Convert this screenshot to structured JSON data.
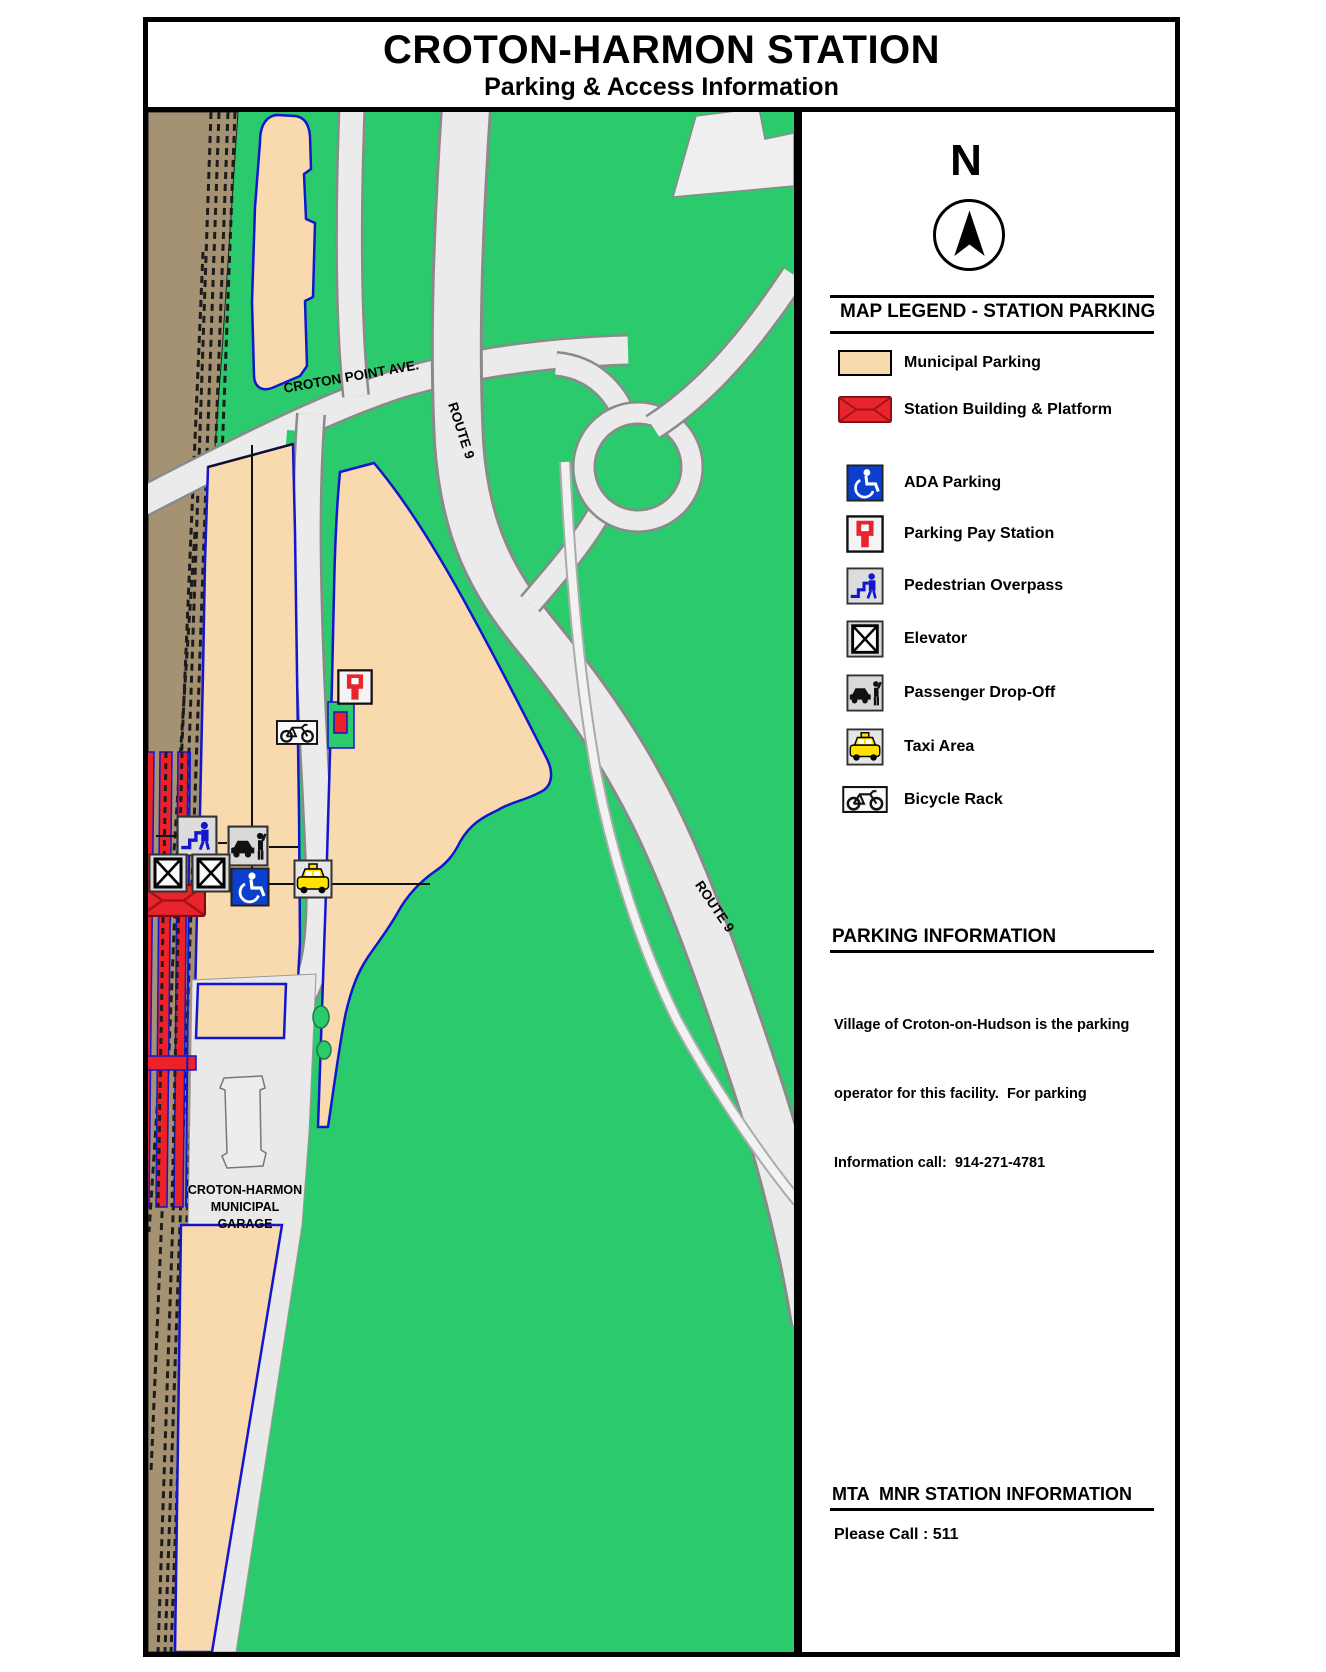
{
  "page": {
    "title": "CROTON-HARMON STATION",
    "subtitle": "Parking & Access Information"
  },
  "compass": {
    "label": "N"
  },
  "legend": {
    "header": "MAP LEGEND - STATION PARKING",
    "items": [
      {
        "id": "municipal",
        "label": "Municipal Parking"
      },
      {
        "id": "station",
        "label": "Station Building & Platform"
      },
      {
        "id": "ada",
        "label": "ADA Parking"
      },
      {
        "id": "pay",
        "label": "Parking Pay Station"
      },
      {
        "id": "ped",
        "label": "Pedestrian Overpass"
      },
      {
        "id": "elevator",
        "label": "Elevator"
      },
      {
        "id": "dropoff",
        "label": "Passenger Drop-Off"
      },
      {
        "id": "taxi",
        "label": "Taxi Area"
      },
      {
        "id": "bike",
        "label": "Bicycle Rack"
      }
    ]
  },
  "map_labels": {
    "croton_point_ave": "CROTON POINT AVE.",
    "route9_upper": "ROUTE 9",
    "route9_lower": "ROUTE 9",
    "garage_lines": [
      "CROTON-HARMON",
      "MUNICIPAL",
      "GARAGE"
    ]
  },
  "parking_info": {
    "header": "PARKING INFORMATION",
    "body_lines": [
      "Village of Croton-on-Hudson is the parking",
      "operator for this facility.  For parking",
      "Information call:  914-271-4781"
    ]
  },
  "mta_info": {
    "header": "MTA  MNR STATION INFORMATION",
    "body": "Please Call : 511"
  },
  "colors": {
    "grass_green": "#2BCB6D",
    "municipal_tan": "#F9D9AE",
    "station_red": "#E8242C",
    "lot_outline_blue": "#1216CE",
    "track_brown": "#A59272",
    "road_gray": "#EBEBEB",
    "garage_gray": "#E9E9E9",
    "ada_blue": "#0A3FD0",
    "taxi_yellow": "#FFE200"
  }
}
